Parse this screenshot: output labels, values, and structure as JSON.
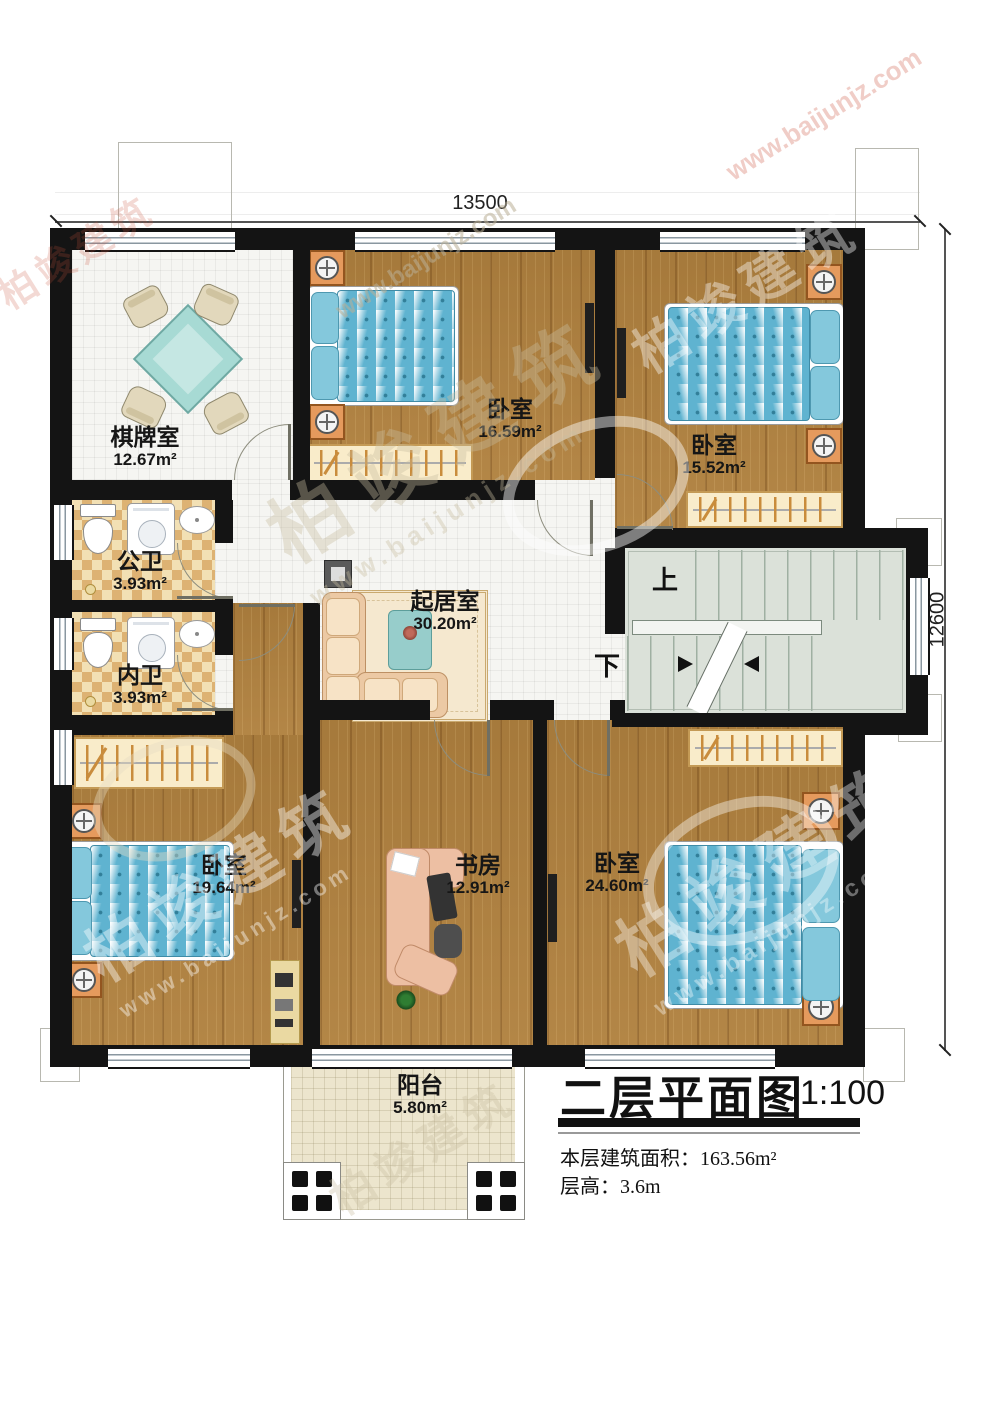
{
  "rooms": {
    "chess": {
      "name": "棋牌室",
      "area": "12.67m²"
    },
    "bedroom1": {
      "name": "卧室",
      "area": "16.59m²"
    },
    "bedroom2": {
      "name": "卧室",
      "area": "15.52m²"
    },
    "bath_public": {
      "name": "公卫",
      "area": "3.93m²"
    },
    "bath_private": {
      "name": "内卫",
      "area": "3.93m²"
    },
    "living": {
      "name": "起居室",
      "area": "30.20m²"
    },
    "bedroom3": {
      "name": "卧室",
      "area": "19.64m²"
    },
    "study": {
      "name": "书房",
      "area": "12.91m²"
    },
    "bedroom4": {
      "name": "卧室",
      "area": "24.60m²"
    },
    "balcony": {
      "name": "阳台",
      "area": "5.80m²"
    }
  },
  "stairs": {
    "up": "上",
    "down": "下"
  },
  "dimensions": {
    "top": "13500",
    "right": "12600"
  },
  "title_block": {
    "title": "二层平面图",
    "scale": "1:100",
    "floor_area": "本层建筑面积：163.56m²",
    "floor_height": "层高：3.6m"
  },
  "watermark": {
    "brand": "柏竣建筑",
    "url": "www.baijunjz.com"
  }
}
